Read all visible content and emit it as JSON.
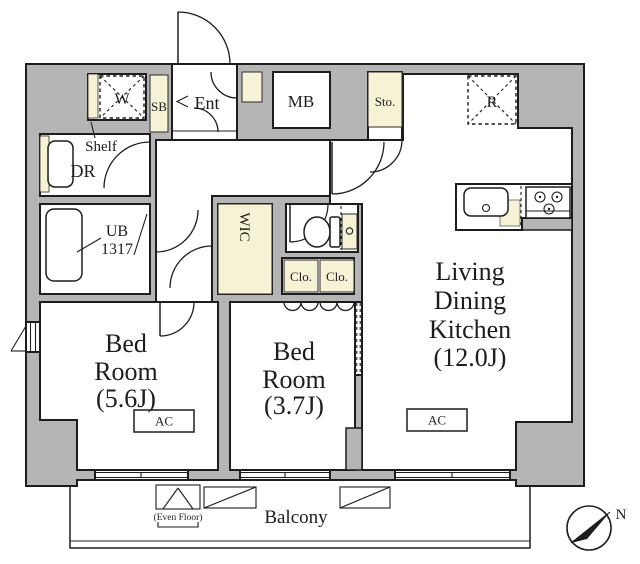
{
  "colors": {
    "wall_fill": "#b5b5b5",
    "line": "#1d1d1d",
    "fixture_fill": "#f6f2d6",
    "floor": "#ffffff"
  },
  "rooms": {
    "living_dining_kitchen": {
      "line1": "Living",
      "line2": "Dining",
      "line3": "Kitchen",
      "size": "(12.0J)"
    },
    "bedroom_main": {
      "line1": "Bed",
      "line2": "Room",
      "size": "(5.6J)"
    },
    "bedroom_second": {
      "line1": "Bed",
      "line2": "Room",
      "size": "(3.7J)"
    },
    "balcony": {
      "label": "Balcony",
      "even_floor": "(Even Floor)"
    },
    "entrance": {
      "label": "Ent"
    },
    "dressing_room": {
      "label": "DR",
      "shelf": "Shelf"
    },
    "unit_bath": {
      "line1": "UB",
      "line2": "1317"
    },
    "walk_in_closet": {
      "label": "WIC"
    },
    "closet_left": {
      "label": "Clo."
    },
    "closet_right": {
      "label": "Clo."
    }
  },
  "fixtures": {
    "washer_space": "W",
    "shoe_box": "SB",
    "meter_box": "MB",
    "storage": "Sto.",
    "refrigerator_space": "R",
    "ac_bedroom": "AC",
    "ac_living": "AC"
  },
  "compass": {
    "north": "N"
  }
}
